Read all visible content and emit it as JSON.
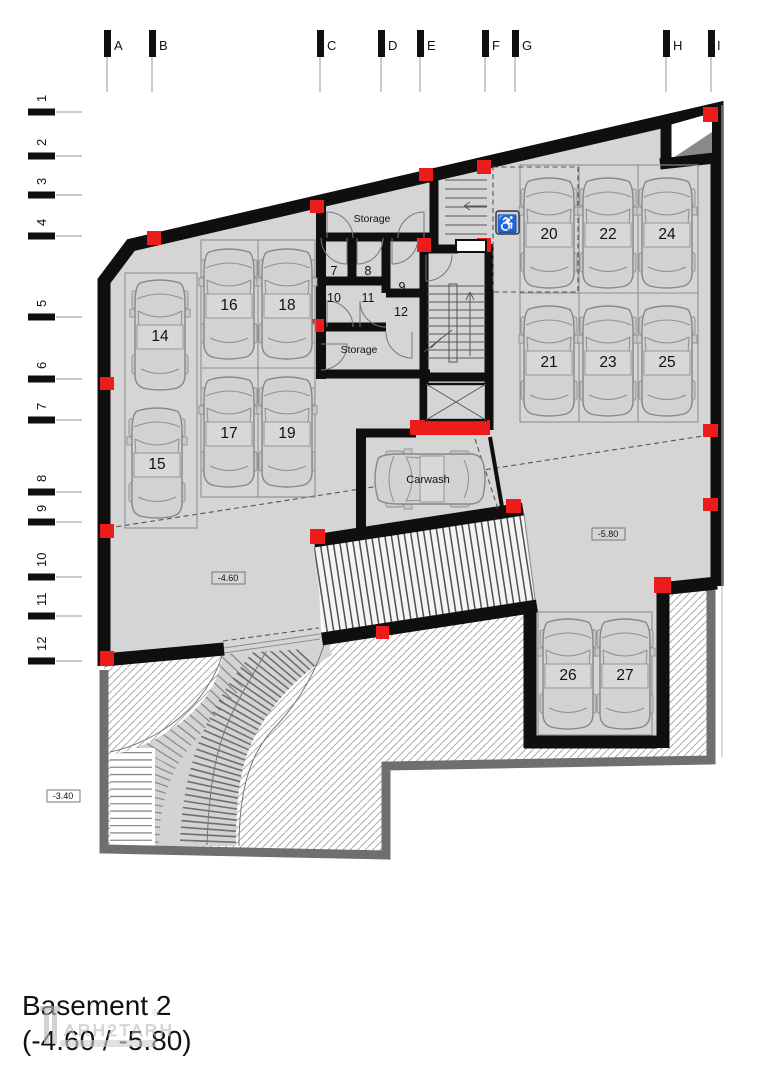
{
  "colors": {
    "accent": "#ed1c1c",
    "wall": "#0f0f0f",
    "floor": "#d5d5d5",
    "outer_wall": "#6f6f6f"
  },
  "grid": {
    "columns": [
      "A",
      "B",
      "C",
      "D",
      "E",
      "F",
      "G",
      "H",
      "I"
    ],
    "rows": [
      "1",
      "2",
      "3",
      "4",
      "5",
      "6",
      "7",
      "8",
      "9",
      "10",
      "11",
      "12"
    ]
  },
  "parking": {
    "s14": "14",
    "s15": "15",
    "s16": "16",
    "s17": "17",
    "s18": "18",
    "s19": "19",
    "s20": "20",
    "s21": "21",
    "s22": "22",
    "s23": "23",
    "s24": "24",
    "s25": "25",
    "s26": "26",
    "s27": "27"
  },
  "rooms": {
    "storage_top": "Storage",
    "storage_bottom": "Storage",
    "r7": "7",
    "r8": "8",
    "r9": "9",
    "r10": "10",
    "r11": "11",
    "r12": "12"
  },
  "areas": {
    "carwash": "Carwash"
  },
  "levels": {
    "main": "-4.60",
    "lower": "-5.80",
    "ramp": "-3.40"
  },
  "title": {
    "name": "Basement 2",
    "levels": "(-4.60 / -5.80)"
  },
  "watermark": {
    "text": "ARH2TARH",
    "reg": "®"
  },
  "icons": {
    "wheelchair_glyph": "♿"
  }
}
